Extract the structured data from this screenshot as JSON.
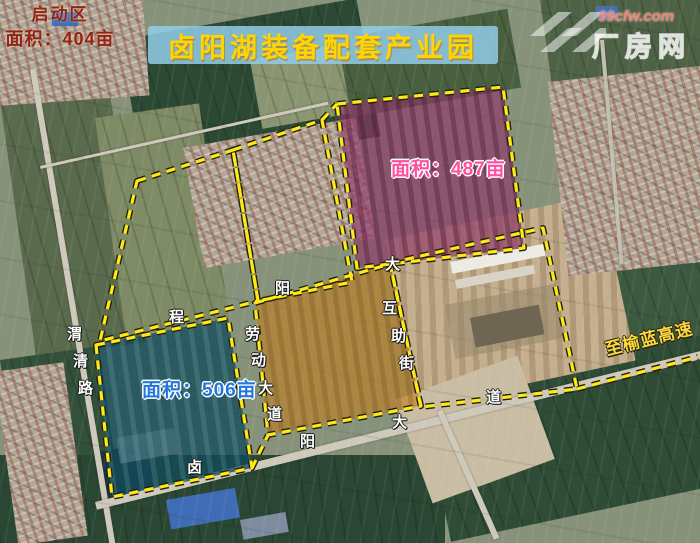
{
  "title": "卤阳湖装备配套产业园",
  "watermark": {
    "site": "99cfw.com",
    "brand": "厂房网"
  },
  "parcels": {
    "north": {
      "area_label": "面积：487亩",
      "area_mu": 487,
      "fill": "#8d3668",
      "label_color": "#ff4f9e"
    },
    "west": {
      "area_label": "面积：506亩",
      "area_mu": 506,
      "fill": "#114a58",
      "label_color": "#2277dd"
    },
    "startup": {
      "name": "启动区",
      "area_label": "面积：404亩",
      "area_mu": 404,
      "fill": "#c08020",
      "label_color": "#8f2417"
    }
  },
  "roads": {
    "weiqing": {
      "name": "渭清路",
      "chars": [
        "渭",
        "清",
        "路"
      ]
    },
    "laodong": {
      "name": "劳动大道",
      "chars": [
        "劳",
        "动",
        "大",
        "道"
      ]
    },
    "dahuzhu": {
      "name": "大互助街",
      "chars": [
        "大",
        "互",
        "助",
        "街"
      ]
    },
    "luyang": {
      "name": "卤阳大道",
      "chars": [
        "卤",
        "阳",
        "大",
        "道"
      ]
    },
    "partial_a": {
      "chars": [
        "程"
      ]
    },
    "partial_b": {
      "chars": [
        "阳"
      ]
    },
    "expressway": {
      "name": "至榆蓝高速"
    }
  },
  "colors": {
    "boundary_dash": "#ffe81a",
    "banner_bg": "#92cde9",
    "title_text": "#ffd400"
  }
}
